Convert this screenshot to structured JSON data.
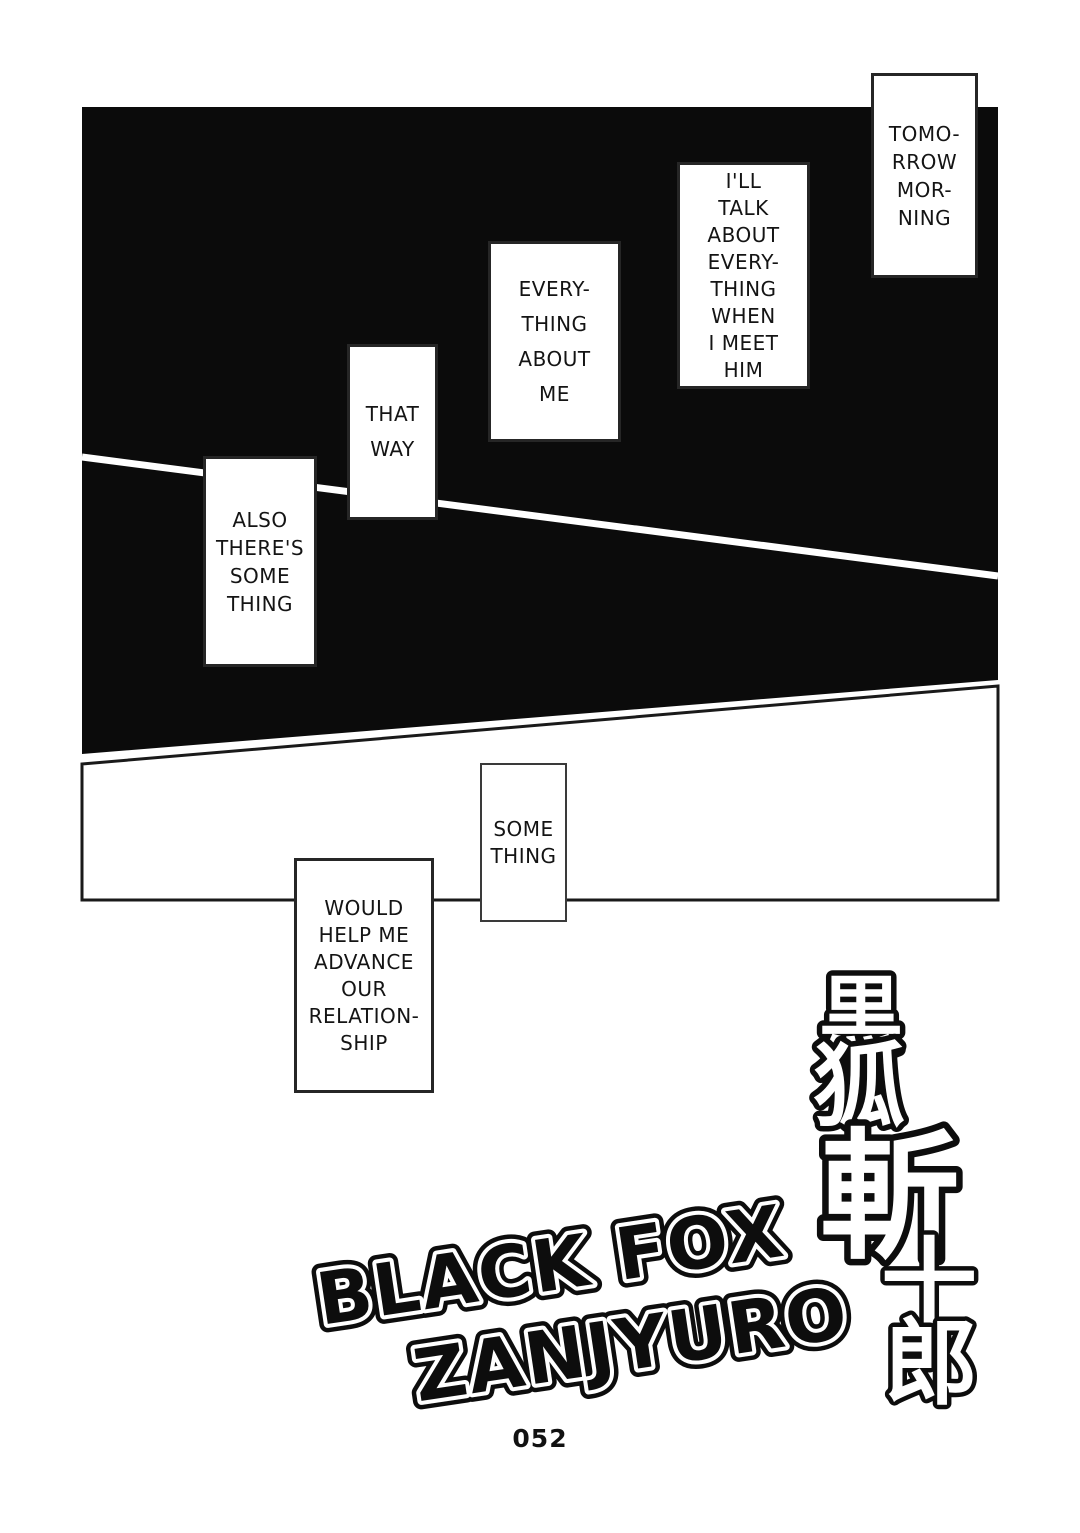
{
  "page": {
    "number": "052",
    "paper_color": "#ffffff",
    "ink_color": "#0d0d0d"
  },
  "bubbles": [
    {
      "id": "tomorrow",
      "lines": [
        "TOMO-",
        "RROW",
        "MOR-",
        "NING"
      ]
    },
    {
      "id": "ill-talk",
      "lines": [
        "I'LL",
        "TALK",
        "ABOUT",
        "EVERY-",
        "THING",
        "WHEN",
        "I MEET",
        "HIM"
      ]
    },
    {
      "id": "everything",
      "lines": [
        "EVERY-",
        "THING",
        "ABOUT",
        "ME"
      ]
    },
    {
      "id": "that-way",
      "lines": [
        "THAT",
        "WAY"
      ]
    },
    {
      "id": "also",
      "lines": [
        "ALSO",
        "THERE'S",
        "SOME",
        "THING"
      ]
    },
    {
      "id": "something",
      "lines": [
        "SOME",
        "THING"
      ]
    },
    {
      "id": "would-help",
      "lines": [
        "WOULD",
        "HELP ME",
        "ADVANCE",
        "OUR",
        "RELATION-",
        "SHIP"
      ]
    }
  ],
  "title": {
    "kanji": [
      "黒",
      "狐",
      "斬",
      "十",
      "郎"
    ],
    "kanji_full": "黒狐斬十郎",
    "english_line1": "BLACK FOX",
    "english_line2": "ZANJYURO"
  }
}
